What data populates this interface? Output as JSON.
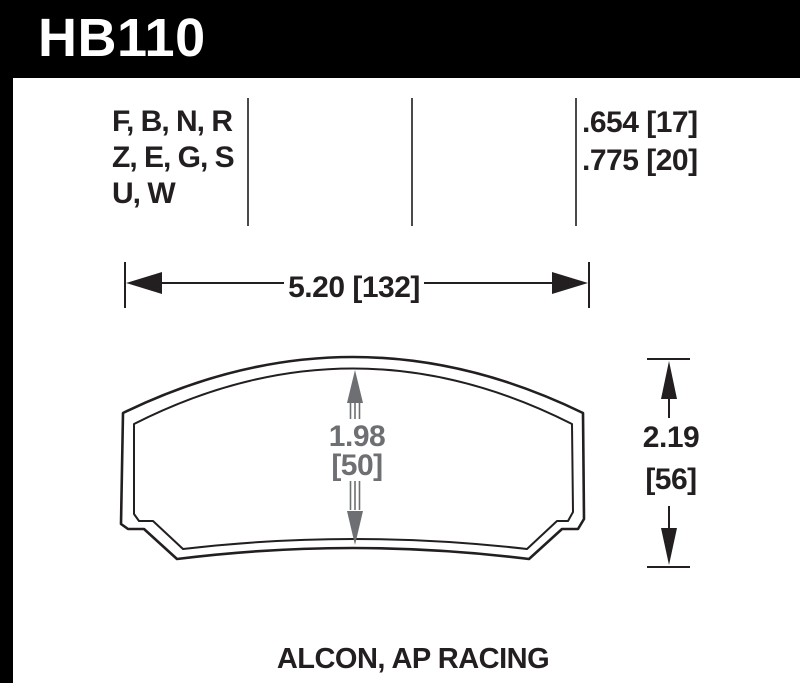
{
  "header": {
    "part_number": "HB110"
  },
  "spec": {
    "compounds": [
      "F, B, N, R",
      "Z, E, G, S",
      "U, W"
    ],
    "thicknesses": [
      ".654 [17]",
      ".775 [20]"
    ]
  },
  "dims": {
    "width_label": "5.20 [132]",
    "height_value": "2.19",
    "height_mm": "[56]",
    "center_value": "1.98",
    "center_mm": "[50]"
  },
  "footer": {
    "applications": "ALCON, AP RACING"
  },
  "colors": {
    "header_bg": "#000000",
    "header_text": "#ffffff",
    "ink": "#231f20",
    "dim_gray": "#6d6f72",
    "separator": "#4a4a4c"
  }
}
